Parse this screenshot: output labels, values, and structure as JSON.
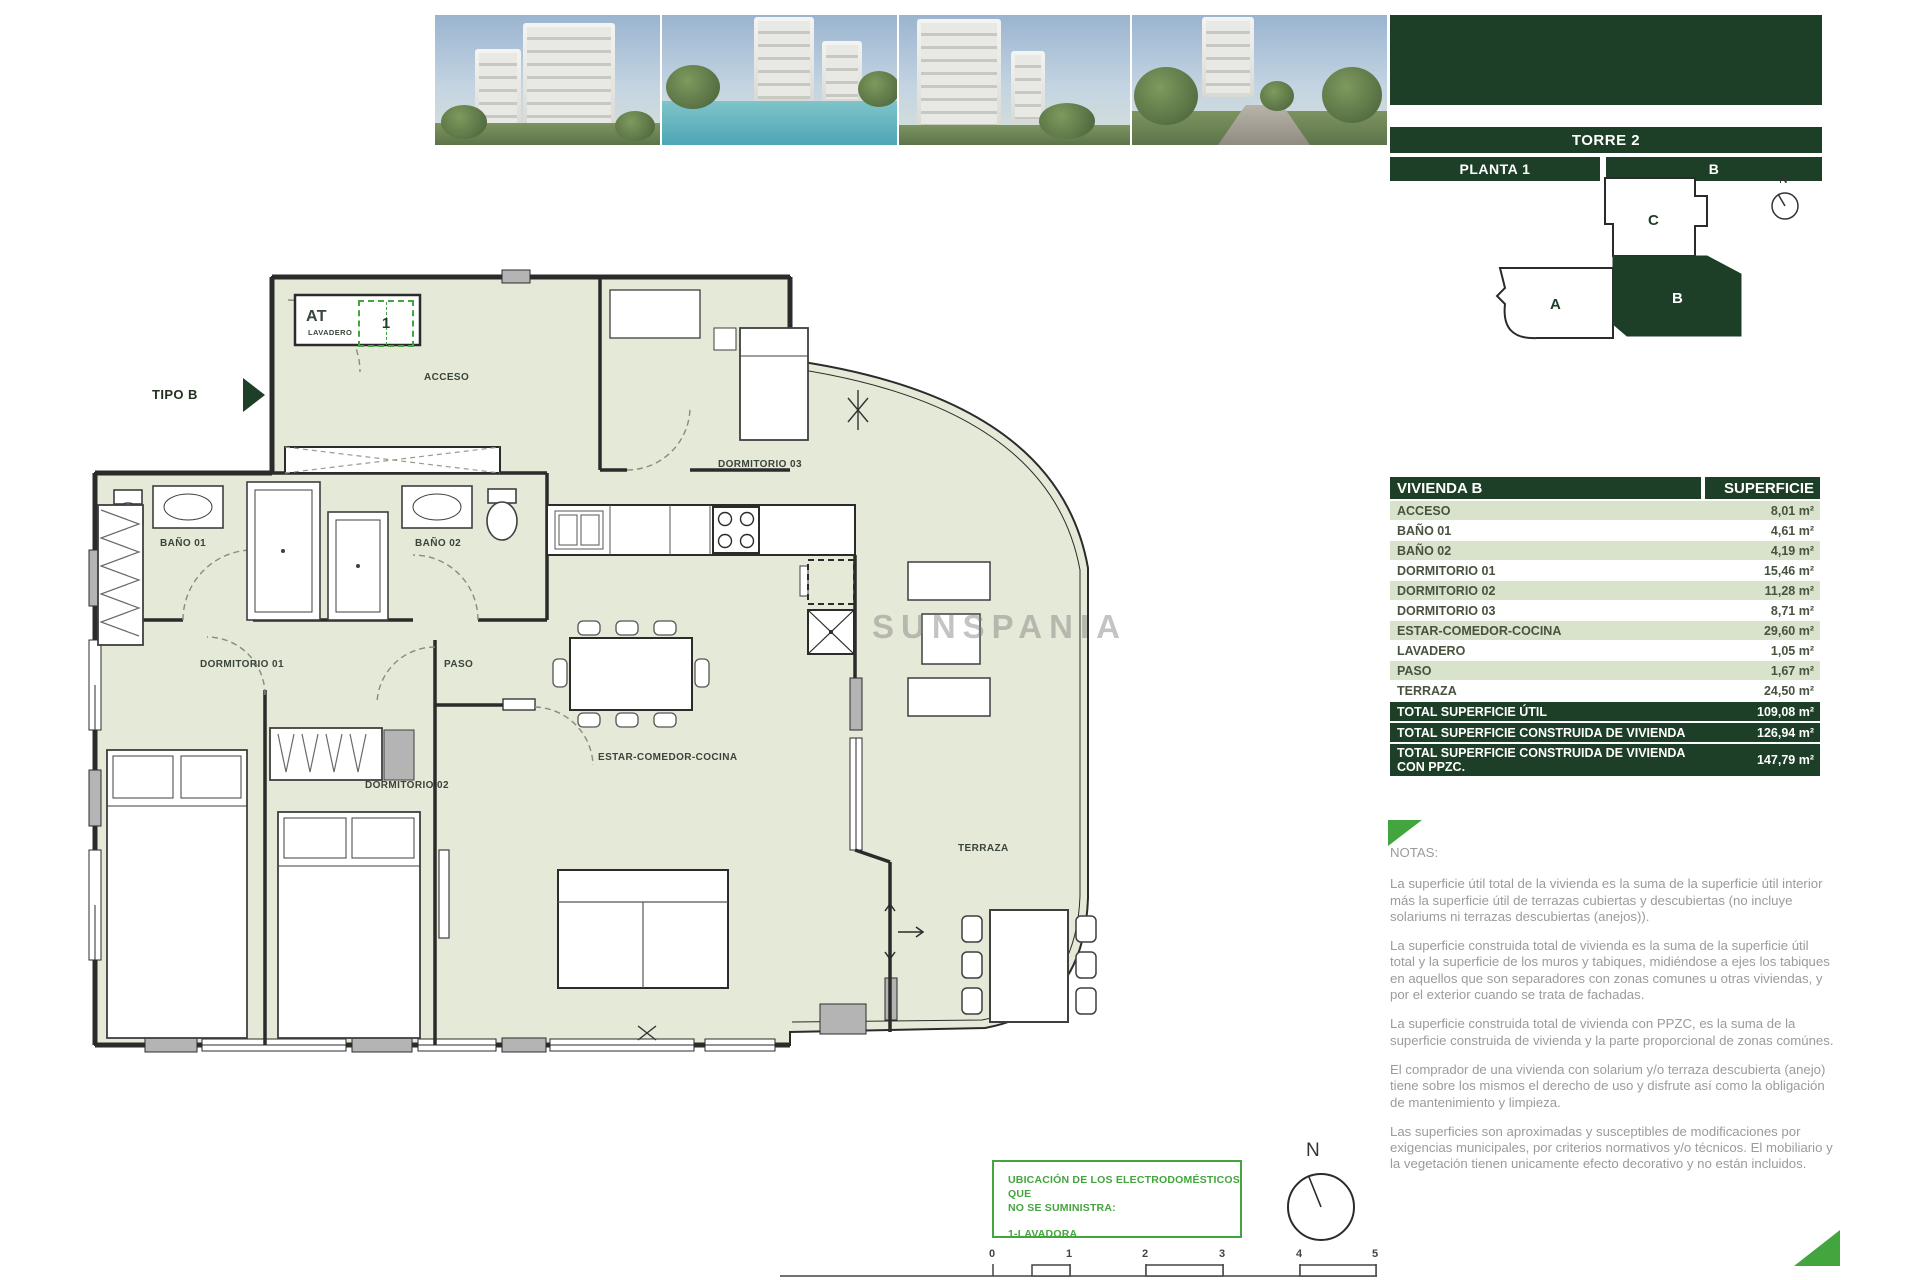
{
  "colors": {
    "dark_green": "#1d3e27",
    "row_green": "#d9e3cc",
    "accent_green": "#43a53d",
    "plan_fill": "#e5e9d8",
    "note_gray": "#9b9b9b"
  },
  "header": {
    "torre": "TORRE 2",
    "planta": "PLANTA 1",
    "unit": "B"
  },
  "keyplan": {
    "a": "A",
    "b": "B",
    "c": "C",
    "compass": "N"
  },
  "table": {
    "title": "VIVIENDA B",
    "col_superficie": "SUPERFICIE",
    "rows": [
      {
        "label": "ACCESO",
        "value": "8,01 m²"
      },
      {
        "label": "BAÑO 01",
        "value": "4,61 m²"
      },
      {
        "label": "BAÑO 02",
        "value": "4,19 m²"
      },
      {
        "label": "DORMITORIO 01",
        "value": "15,46 m²"
      },
      {
        "label": "DORMITORIO 02",
        "value": "11,28 m²"
      },
      {
        "label": "DORMITORIO 03",
        "value": "8,71 m²"
      },
      {
        "label": "ESTAR-COMEDOR-COCINA",
        "value": "29,60 m²"
      },
      {
        "label": "LAVADERO",
        "value": "1,05 m²"
      },
      {
        "label": "PASO",
        "value": "1,67 m²"
      },
      {
        "label": "TERRAZA",
        "value": "24,50 m²"
      }
    ],
    "totals": [
      {
        "label": "TOTAL SUPERFICIE ÚTIL",
        "value": "109,08 m²"
      },
      {
        "label": "TOTAL SUPERFICIE CONSTRUIDA DE VIVIENDA",
        "value": "126,94 m²"
      },
      {
        "label": "TOTAL SUPERFICIE CONSTRUIDA DE VIVIENDA CON PPZC.",
        "value": "147,79 m²"
      }
    ]
  },
  "notes": {
    "title": "NOTAS:",
    "paragraphs": [
      "La superficie útil total de la vivienda es la suma de la superficie útil interior más la superficie útil de terrazas cubiertas y descubiertas (no incluye solariums ni terrazas descubiertas (anejos)).",
      "La superficie construida total de vivienda es la suma de la superficie útil total y la superficie de los muros y tabiques, midiéndose a ejes los tabiques en aquellos que son separadores con zonas comunes u otras viviendas, y por el exterior cuando se trata de fachadas.",
      "La superficie construida total de vivienda con PPZC, es la suma de la superficie construida de vivienda y la parte proporcional de zonas comúnes.",
      "El comprador de una vivienda con solarium y/o terraza descubierta (anejo) tiene sobre los mismos el derecho de uso y disfrute así como la obligación de mantenimiento y limpieza.",
      "Las superficies son aproximadas y susceptibles de modificaciones por exigencias municipales, por criterios normativos y/o técnicos. El mobiliario y la vegetación tienen unicamente efecto decorativo y no están incluidos."
    ]
  },
  "plan": {
    "tipo": "TIPO B",
    "at": "AT",
    "lavadero": "LAVADERO",
    "appliance_num": "1",
    "acceso": "ACCESO",
    "bano01": "BAÑO 01",
    "bano02": "BAÑO 02",
    "dorm01": "DORMITORIO 01",
    "dorm02": "DORMITORIO 02",
    "dorm03": "DORMITORIO 03",
    "paso": "PASO",
    "estar": "ESTAR-COMEDOR-COCINA",
    "terraza": "TERRAZA",
    "watermark": "SUNSPANIA"
  },
  "footer": {
    "appliance_line1": "UBICACIÓN DE LOS ELECTRODOMÉSTICOS QUE",
    "appliance_line2": "NO SE SUMINISTRA:",
    "appliance_line3": "1-LAVADORA",
    "compass": "N",
    "scale_ticks": [
      "0",
      "1",
      "2",
      "3",
      "4",
      "5"
    ]
  }
}
